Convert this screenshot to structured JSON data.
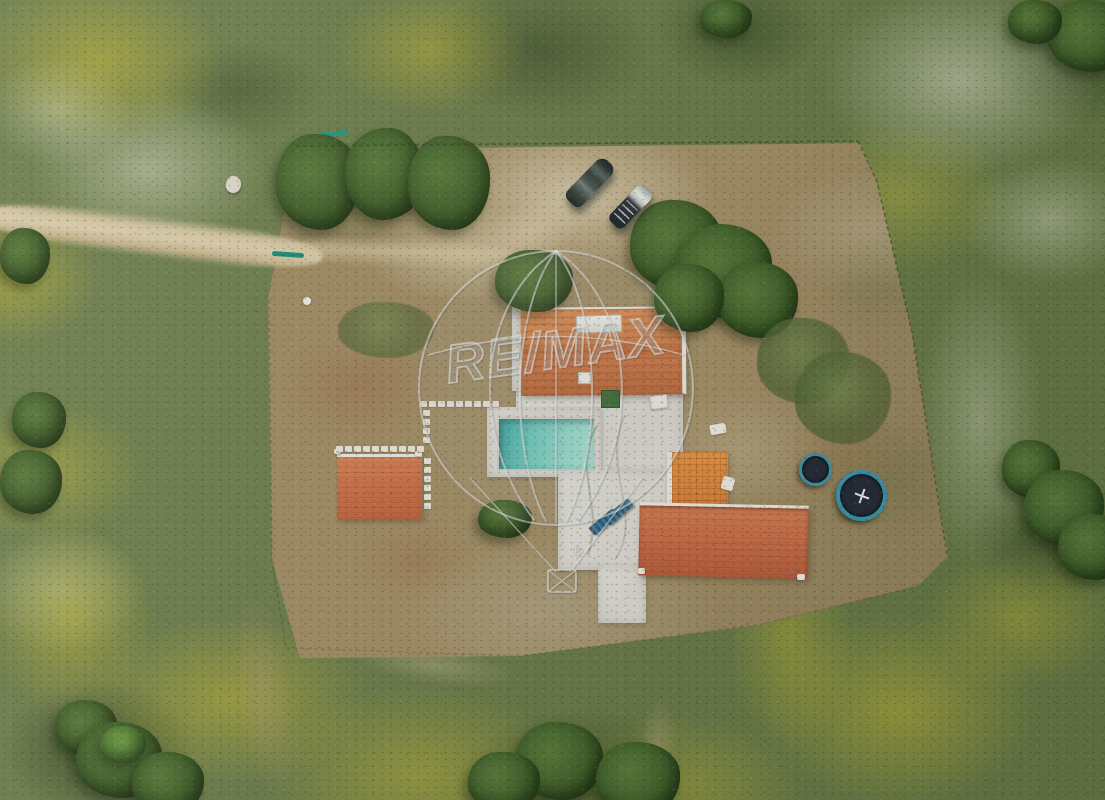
{
  "meta": {
    "kind": "aerial-drone-photograph",
    "description": "Overhead drone photo of a fenced rural property: white-paved villa with terracotta roofs, swimming pool, sun loungers, outbuilding, two parked cars, two trampolines, dirt road and flowering grassland"
  },
  "watermark": {
    "text": "RE/MAX",
    "registered_symbol": "®"
  },
  "scene": {
    "ground": {
      "grass_green": "#6d7c4c",
      "dirt_brown": "#9c8962",
      "road_tan": "#d2c4a2",
      "flower_yellow": "#c4b734",
      "flower_white": "#d7dac4"
    },
    "buildings": {
      "main_roof_terracotta": "#cd7a45",
      "south_wing_roof": "#c26a47",
      "east_annex_roof": "#de8e44",
      "outbuilding_roof": "#c96f4a",
      "patio_white": "#dcd9d3"
    },
    "pool": {
      "water_turquoise": "#7fcfc2",
      "deck_white": "#dedbd5"
    },
    "objects": {
      "cars_count": 2,
      "sun_loungers_count": 2,
      "trampolines_count": 2,
      "lounger_blue": "#35648a",
      "trampoline_rim_teal": "#3f9ab0"
    }
  }
}
